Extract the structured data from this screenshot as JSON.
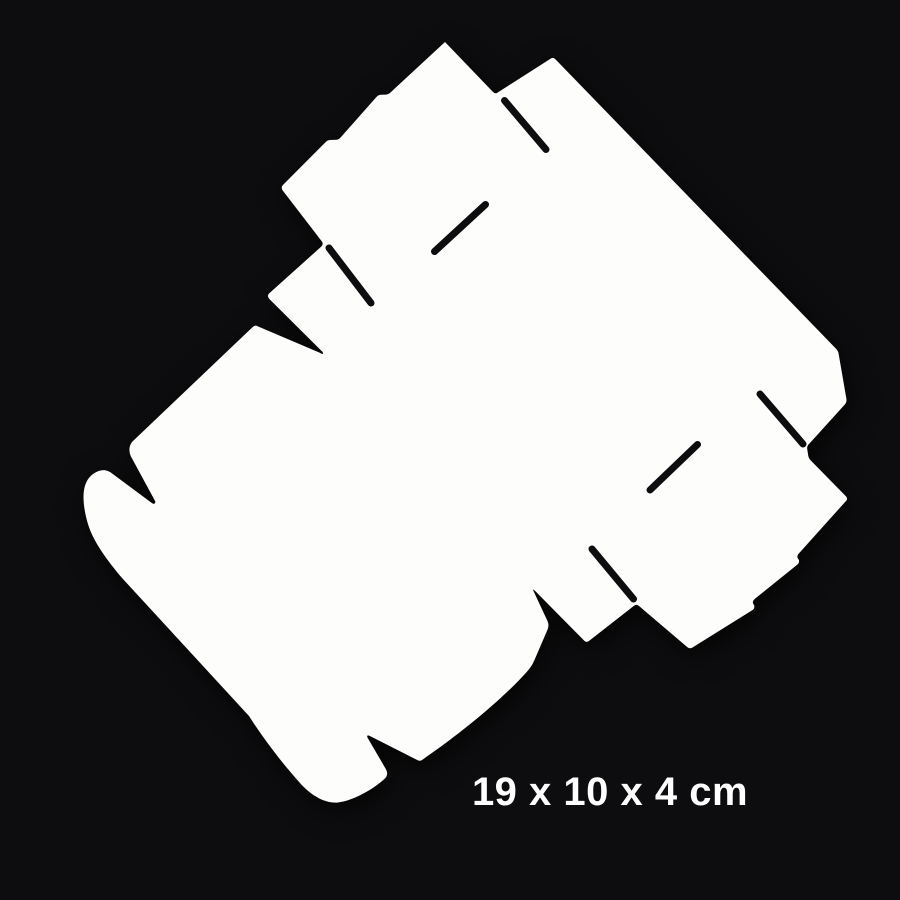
{
  "meta": {
    "description": "Product photo of an unfolded white cardboard box die-cut blank on a black background",
    "label_text": "19 x 10 x 4 cm"
  },
  "colors": {
    "background": "#0d0c0e",
    "box_white_center": "#fdfdfc",
    "box_white_edge": "#f2f1ef",
    "slot_dark": "#0d0c0e",
    "label_text": "#ffffff"
  },
  "shape": {
    "outline_path": "M 445,42 L 492.8,91.7 Q 495.2,94.3 497.3,92.7 L 550.3,58.9 Q 553.1,56.8 555.4,59.2 L 835.7,348.4 Q 838.1,350.9 838.5,353.1 L 846.4,398.8 Q 847.0,402.3 844.6,404.8 L 809.7,443.3 Q 806.8,445.8 807.2,448.8 L 808.2,455.5 Q 808.7,458.4 810.8,460.5 L 845.9,496.2 Q 848.3,498.7 846.2,500.8 L 799.3,553.0 Q 796.9,555.3 797.5,557.7 L 798.9,560.0 Q 799.6,562.4 797.8,564.2 L 754.8,598.9 Q 752.4,601.0 753.0,603.3 L 754.2,605.5 Q 754.9,607.9 753.0,609.7 L 693.3,647.0 Q 690.0,649.6 687.0,646.9 L 639.0,606.0 Q 636.5,603.7 634.2,605.6 L 588.9,641.0 Q 586.5,642.9 584.3,640.8 L 534.9,590.8 Q 532.1,587.9 533.7,591.5 L 547.6,621.3 Q 549.3,625.5 547.5,629.7 L 534.1,660.9 Q 532.3,665.1 529.4,668.7 C 513.0,688.9 468.7,727.8 426.8,756.5 L 423.5,759.0 Q 420.4,761.7 417.7,760.3 L 370.4,736.2 Q 366.2,733.9 367.5,737.6 L 385.6,768.6 Q 388.9,773.9 385.2,778.3 C 371.5,790.8 352.0,800.9 338.0,802.5 C 323.5,803.6 310.0,794.0 300.5,783.6 C 281.5,762.5 263.0,738.0 249.0,716.0 L 122.5,578.5 C 107.5,561.0 92.8,541.0 87.8,523.5 C 84.3,511.5 82.8,500.0 83.8,491.5 C 84.7,484.5 87.3,478.8 91.5,475.2 C 95.5,471.9 100.5,469.8 105.0,470.2 Q 108.0,470.5 110.6,472.4 L 151.5,502.8 Q 154.8,505.4 155.4,501.6 L 130.9,456.4 C 128.6,451.2 128.9,445.3 132.6,441.4 L 252.6,327.1 Q 255.1,324.7 257.6,326.3 L 319.8,352.8 Q 324.1,355.6 322.6,352.0 L 269.6,299.3 Q 266.7,296.3 268.9,293.6 L 321.1,246.7 Q 323.7,244.3 322.1,241.7 L 283.0,190.9 Q 280.5,187.6 282.9,185.0 L 326.0,141.7 Q 327.5,140.1 329.7,140.0 L 336.3,139.7 Q 338.4,139.6 340.0,138.1 L 377.0,96.4 Q 378.5,94.9 380.6,94.8 L 386.1,94.6 Q 388.2,94.5 389.9,93.0 Z",
    "slits": [
      {
        "name": "slot-top-left-panel",
        "path": "M 434.5,251.5 L 485.5,204.5"
      },
      {
        "name": "slot-top-valley",
        "path": "M 504.5,100.5 L 546.0,149.5"
      },
      {
        "name": "slot-left-junction",
        "path": "M 329.0,248.0 L 371.0,303.0"
      },
      {
        "name": "slot-right-panel",
        "path": "M 650.0,490.0 L 697.5,444.5"
      },
      {
        "name": "slot-bottom-middle",
        "path": "M 592.0,549.0 L 633.5,599.0"
      },
      {
        "name": "slot-right-edge",
        "path": "M 760.0,394.0 L 803.0,444.0"
      }
    ],
    "slit_stroke_width": 7,
    "gradient": {
      "cx": "44%",
      "cy": "42%",
      "r": "75%"
    }
  }
}
